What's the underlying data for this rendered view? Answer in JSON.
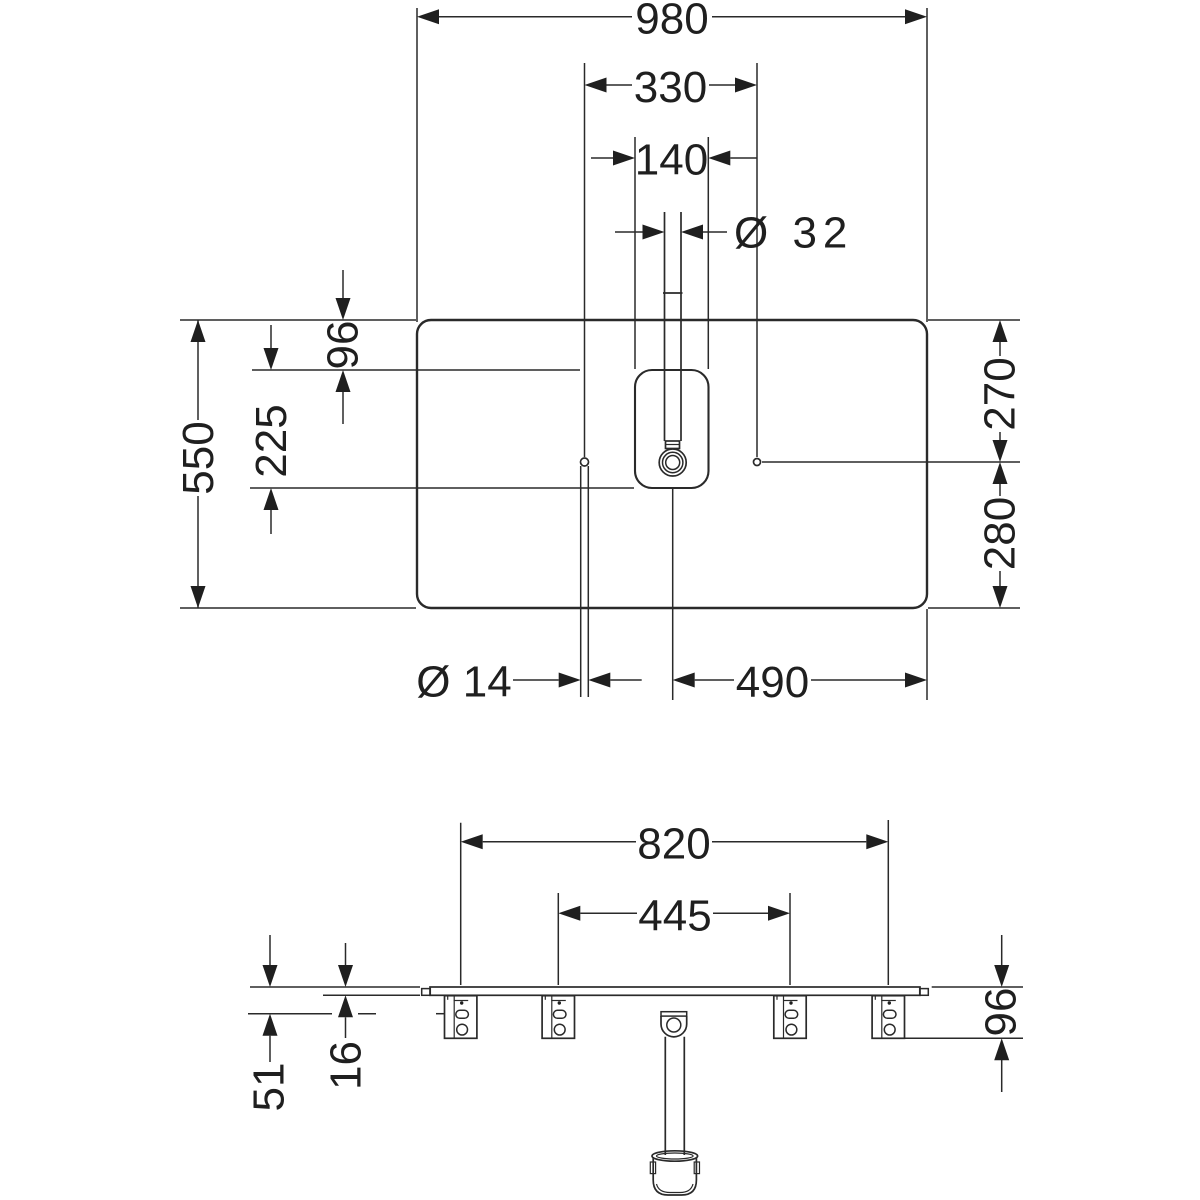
{
  "drawing": {
    "type": "installation dimension drawing",
    "views": [
      "top view (plan)",
      "front view (elevation)"
    ],
    "units": "mm",
    "top_view": {
      "overall_width": "980",
      "hole_spacing": "330",
      "cutout_width": "140",
      "drain_diameter": "Ø 32",
      "overall_depth": "550",
      "cutout_offset_back": "96",
      "cutout_depth": "225",
      "holes_from_back": "270",
      "holes_from_front": "280",
      "hole_diameter": "Ø 14",
      "drain_to_edge": "490"
    },
    "front_view": {
      "outer_bracket_spacing": "820",
      "inner_bracket_spacing": "445",
      "bracket_hole_offset": "51",
      "panel_thickness": "16",
      "bracket_drop": "96"
    },
    "line_color": "#2a2a2a",
    "background_color": "#ffffff"
  }
}
